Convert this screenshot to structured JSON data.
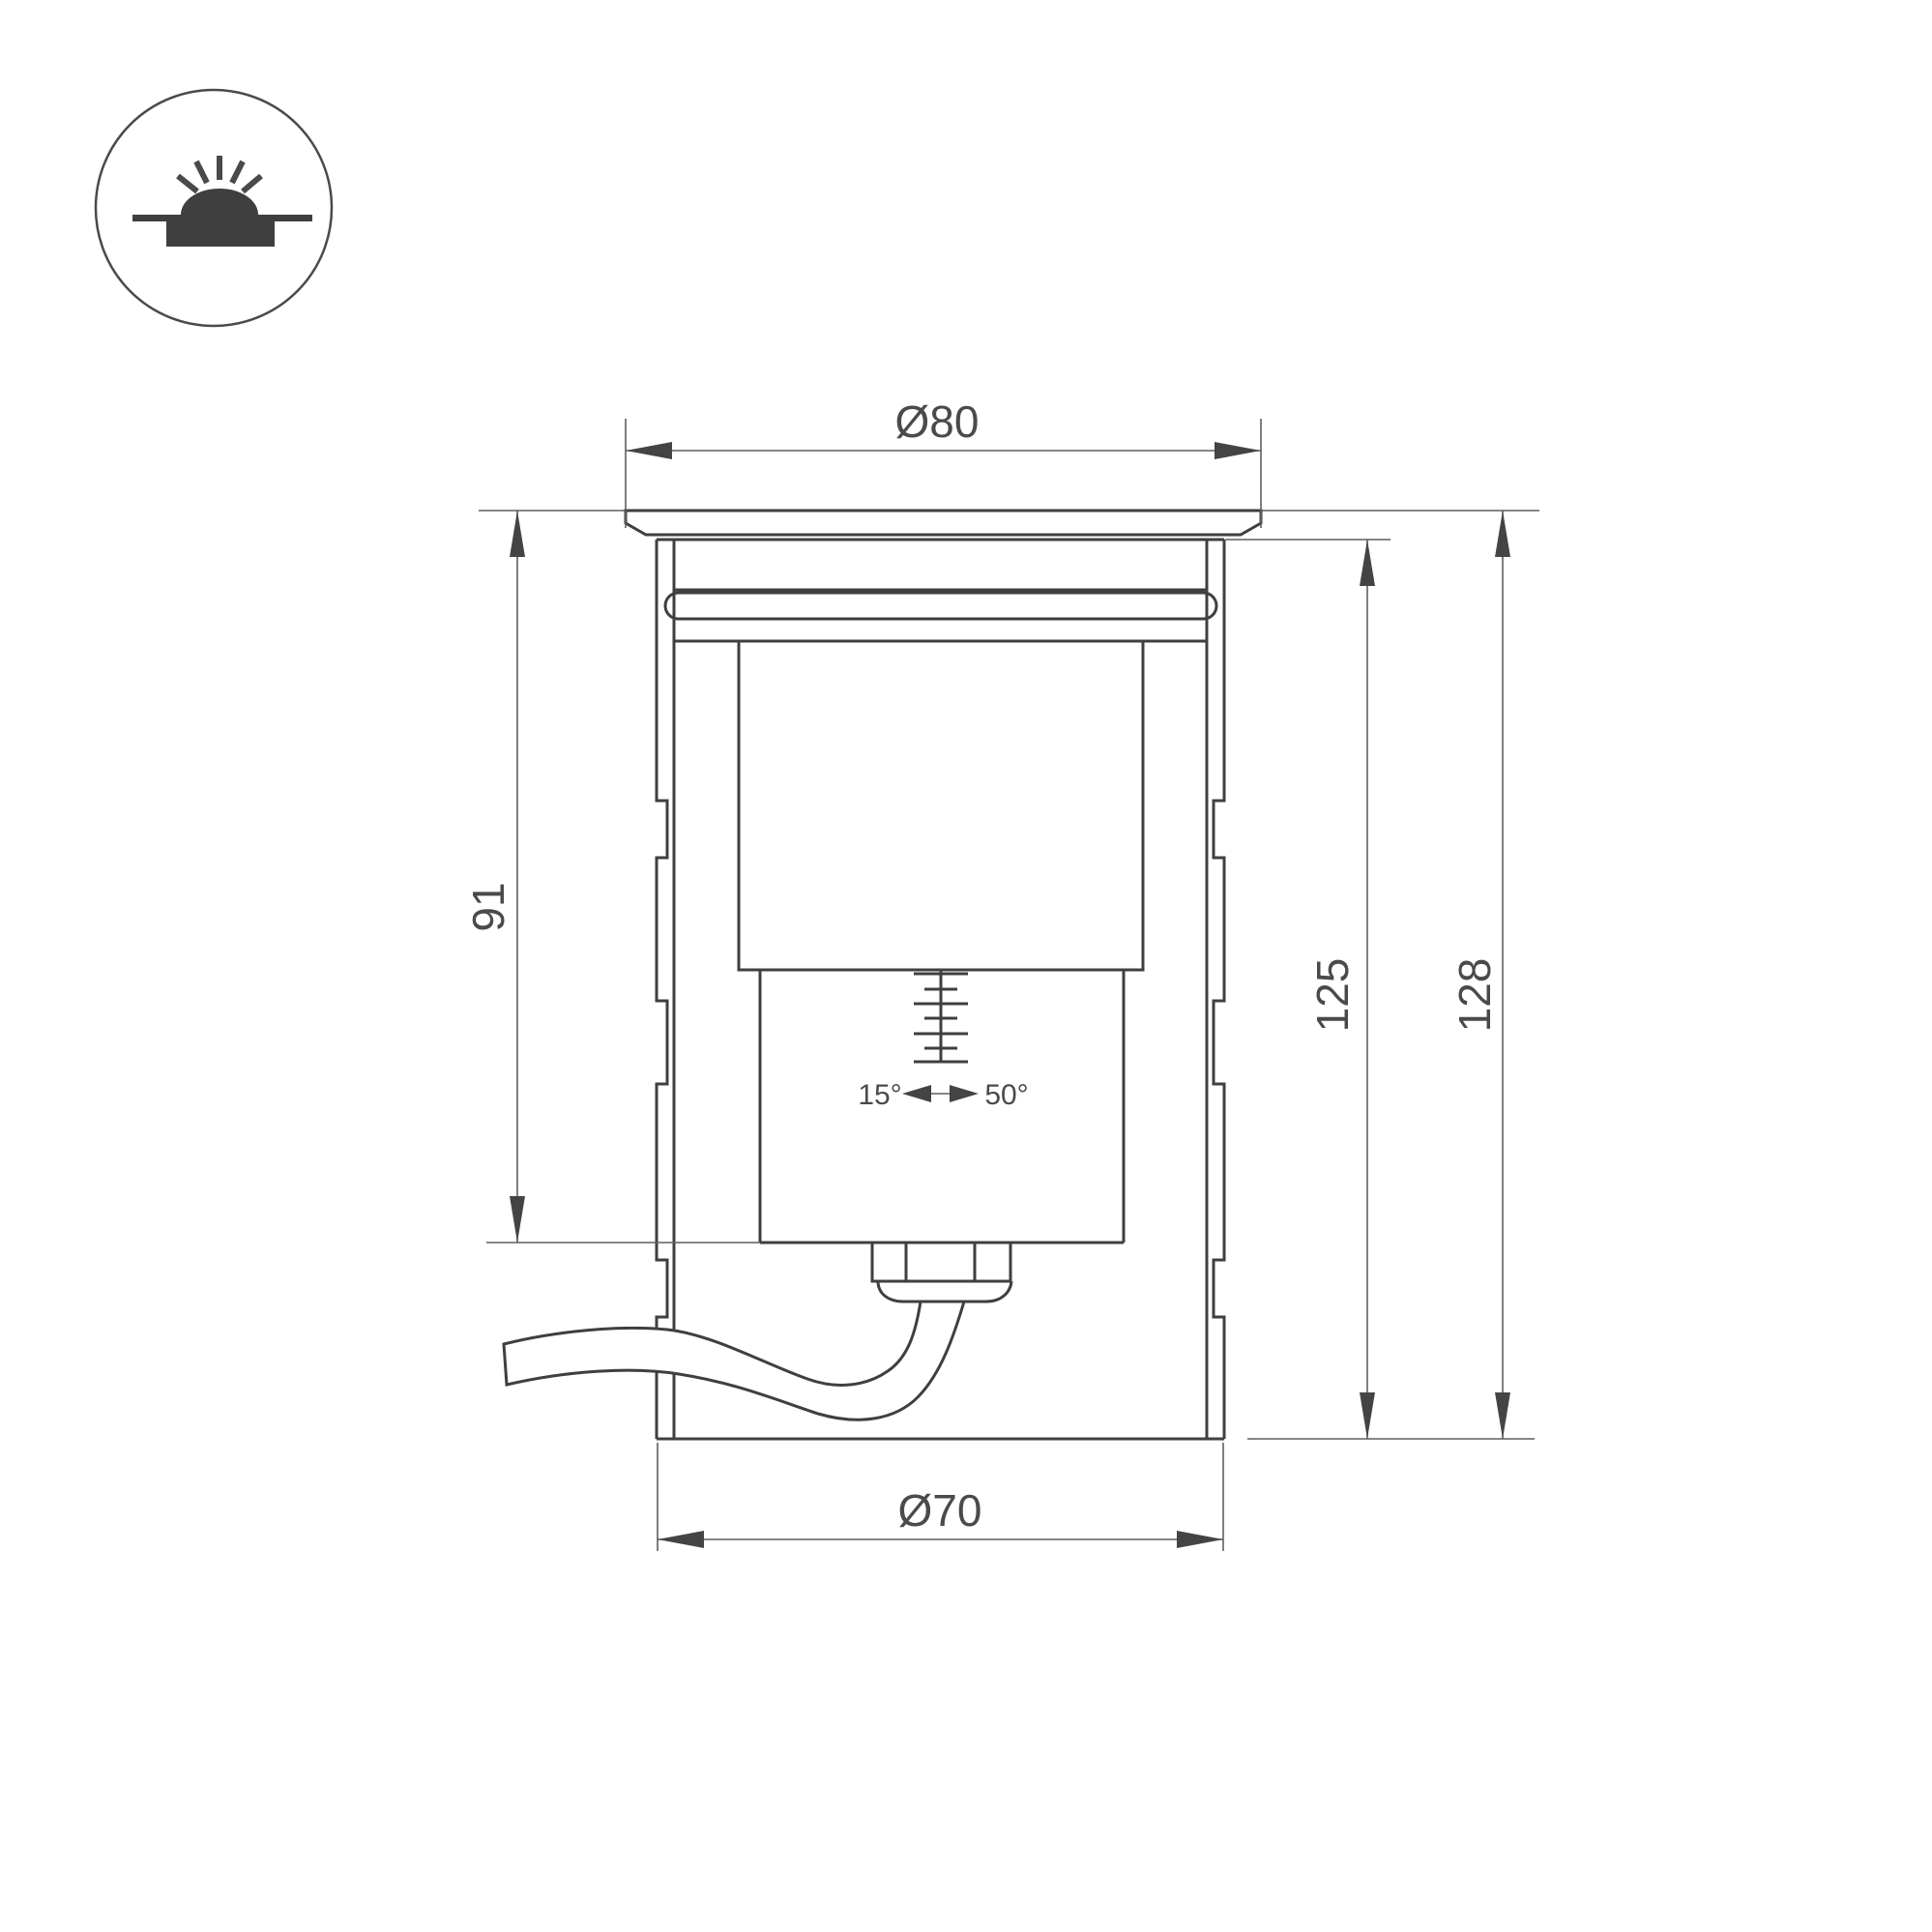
{
  "drawing_type": "luminaire-technical-drawing",
  "colors": {
    "background": "#ffffff",
    "outline": "#3f3f3f",
    "dimension_line": "#5f5f5f",
    "text": "#4a4a4a"
  },
  "dimensions": {
    "top_diameter": "Ø80",
    "bottom_diameter": "Ø70",
    "recess_depth": "91",
    "housing_height": "125",
    "overall_height": "128"
  },
  "tilt": {
    "min_angle": "15°",
    "max_angle": "50°"
  }
}
